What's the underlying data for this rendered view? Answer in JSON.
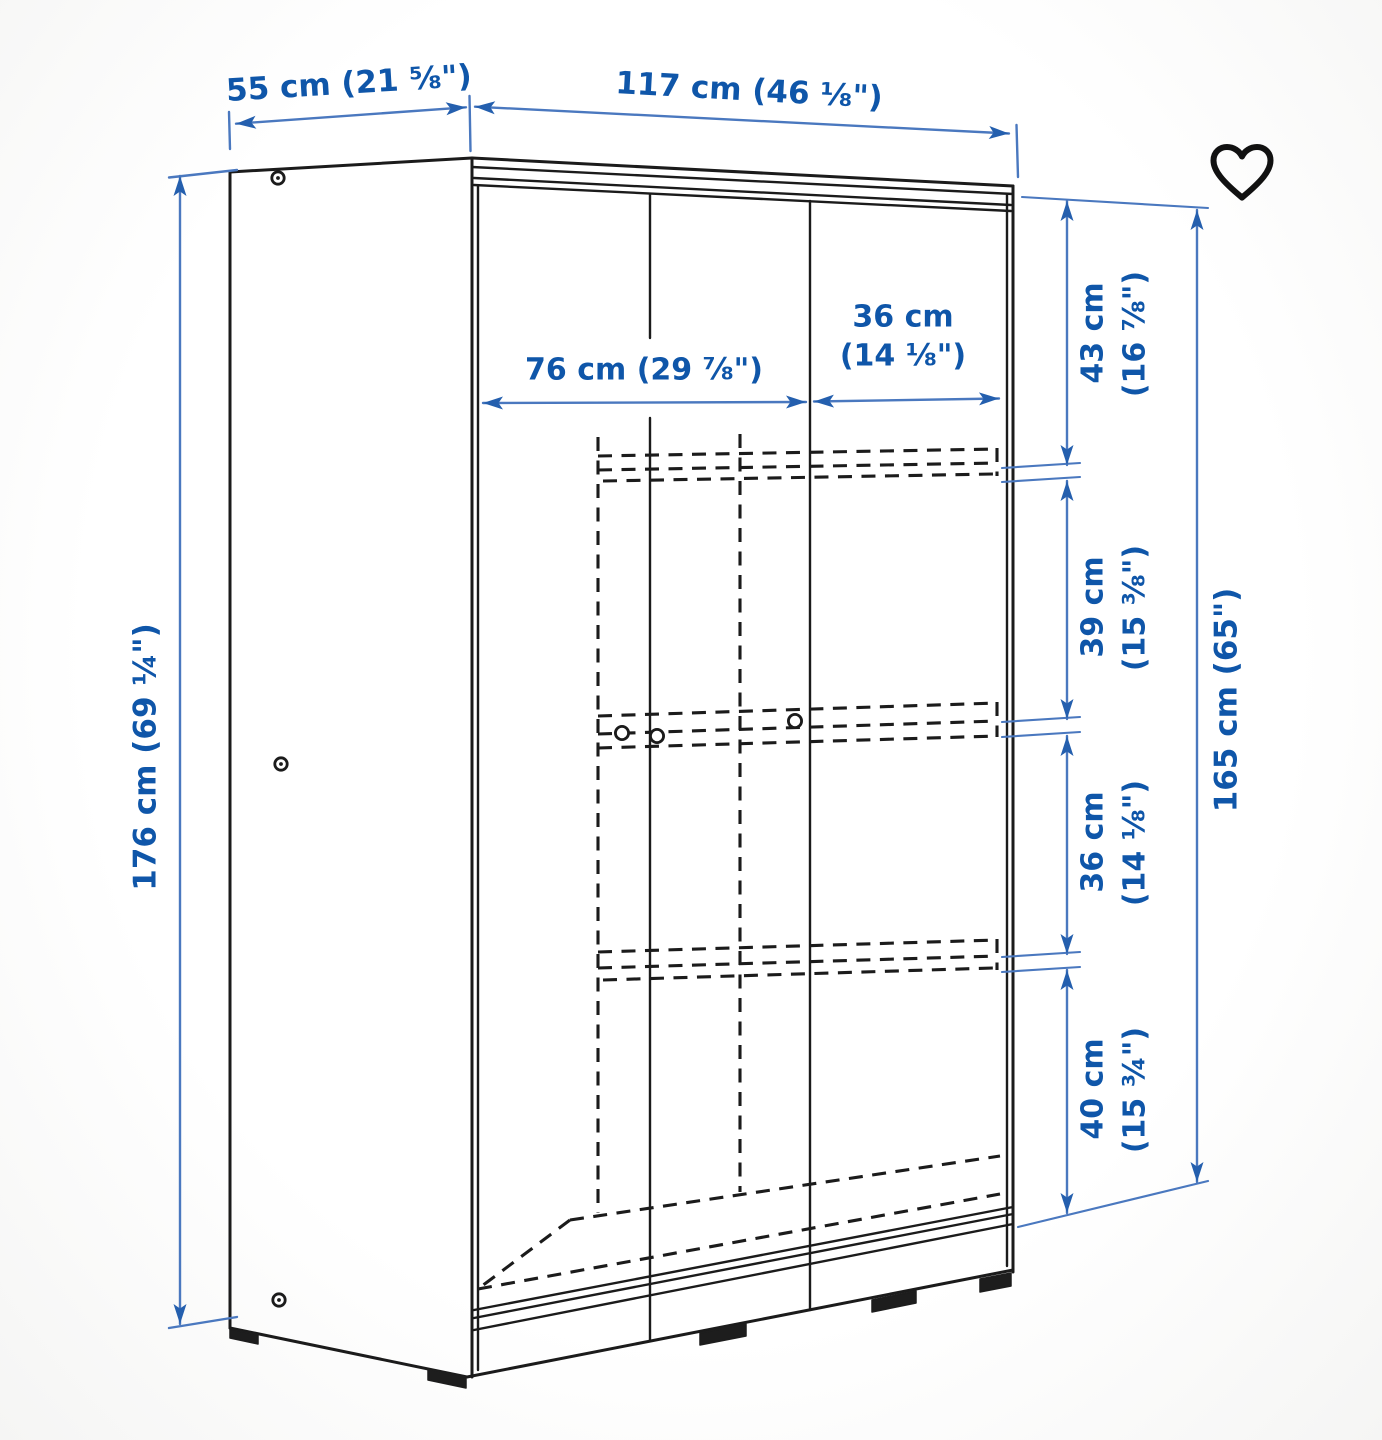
{
  "page": {
    "type": "product dimension diagram",
    "product": "sliding-door wardrobe line drawing",
    "background": "#ffffff"
  },
  "colors": {
    "dimension_text": "#0f56a9",
    "dimension_line": "#4a78bf",
    "drawing_line": "#1b1b1b",
    "favorite_icon": "#111111"
  },
  "favorite": {
    "icon": "heart-outline",
    "label": "favorite"
  },
  "dimensions": {
    "depth": "55 cm (21 ⅝\")",
    "width": "117 cm (46 ⅛\")",
    "height": "176 cm (69 ¼\")",
    "interior_width_left": "76 cm (29 ⅞\")",
    "interior_width_right_l1": "36 cm",
    "interior_width_right_l2": "(14 ⅛\")",
    "section_1_l1": "43 cm",
    "section_1_l2": "(16 ⅞\")",
    "section_2_l1": "39 cm",
    "section_2_l2": "(15 ⅜\")",
    "section_3_l1": "36 cm",
    "section_3_l2": "(14 ⅛\")",
    "section_4_l1": "40 cm",
    "section_4_l2": "(15 ¾\")",
    "interior_height": "165 cm (65\")"
  }
}
